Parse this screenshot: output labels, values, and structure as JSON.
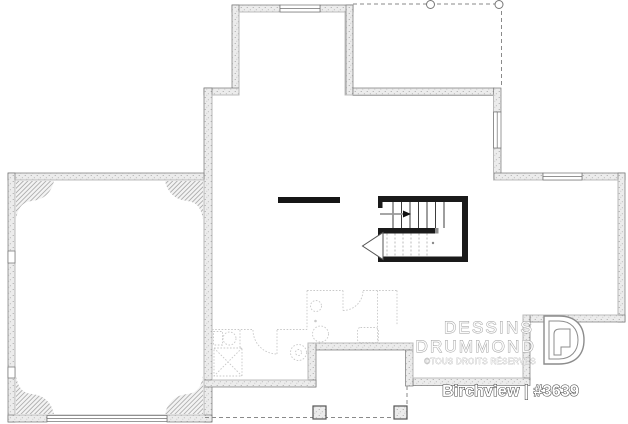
{
  "sheet": {
    "background": "#ffffff",
    "width": 628,
    "height": 424
  },
  "branding": {
    "name_line1": "DESSINS",
    "name_line2": "DRUMMOND",
    "rights": "©TOUS DROITS RÉSERVÉS",
    "logo_icon": "drummond-d-logo"
  },
  "plan": {
    "label": "Birchview | #3639",
    "model_name": "Birchview",
    "plan_number": "#3639"
  },
  "drawing": {
    "colors": {
      "wall_fill": "#ececec",
      "wall_outline": "#777777",
      "stair_wall": "#1a1a1a",
      "faint_layout": "#c9c9c9",
      "dashed_outline": "#8a8a8a"
    },
    "features": [
      "foundation-walls",
      "garage-with-hatched-corners",
      "garage-door-opening",
      "u-shaped-stairwell",
      "stair-direction-arrow",
      "windows",
      "covered-porch-dashed-top",
      "rear-porch-dashed-bottom-with-posts",
      "suggested-bathroom-layout",
      "suggested-mechanical-room"
    ]
  }
}
